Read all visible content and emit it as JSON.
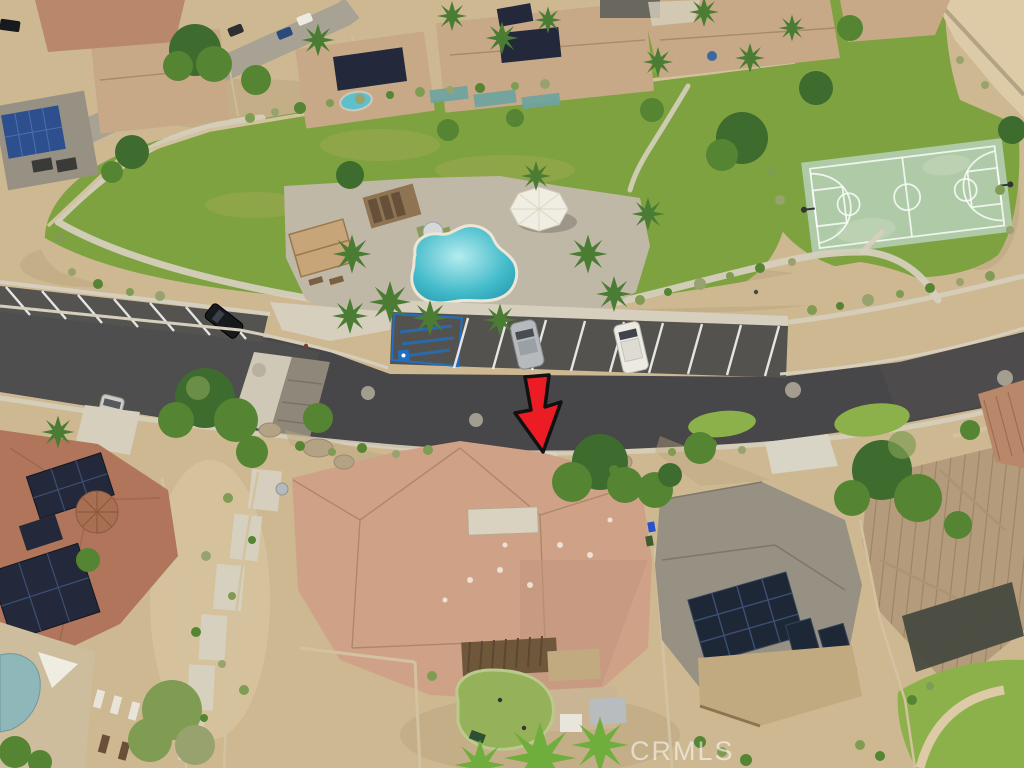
{
  "watermark": {
    "text": "CRMLS"
  },
  "palette": {
    "sand": "#cdb892",
    "sandDark": "#bba57e",
    "sandLight": "#ddcaa6",
    "lawn": "#7da23f",
    "lawnLight": "#8db14a",
    "lawnDry": "#a8ad58",
    "court": "#aecaa6",
    "deck": "#c0b8a6",
    "concrete": "#d6cfbd",
    "paver": "#8f877a",
    "asphalt": "#474648",
    "handicapBlue": "#1f6fc4",
    "poolWater": "#45bccb",
    "poolShallow": "#b5ecef",
    "roofTerracotta": "#b0755a",
    "roofTan": "#c7a988",
    "roofRed": "#b9886a",
    "roofSubject": "#cfa288",
    "roofGray": "#969183",
    "roofMetal": "#b39b7c",
    "solarDark": "#23293a",
    "solarBlue": "#2d4f8e",
    "treeDark": "#3e6b2e",
    "treeMid": "#558433",
    "treeOlive": "#7f9c52",
    "shrubGray": "#98a26e",
    "palm": "#4a7c33",
    "turf": "#95b159",
    "pergola": "#6f573c",
    "awning": "#c2aa80",
    "awningDark": "#474a40",
    "wall": "#d3c2a0",
    "carBlack": "#17191d",
    "carSilver": "#b7babd",
    "carWhite": "#eceae3",
    "carBlue": "#2a4a7a",
    "arrowRed": "#ec1c24",
    "arrowStroke": "#111111",
    "watermark": "rgba(255,255,255,0.55)"
  }
}
